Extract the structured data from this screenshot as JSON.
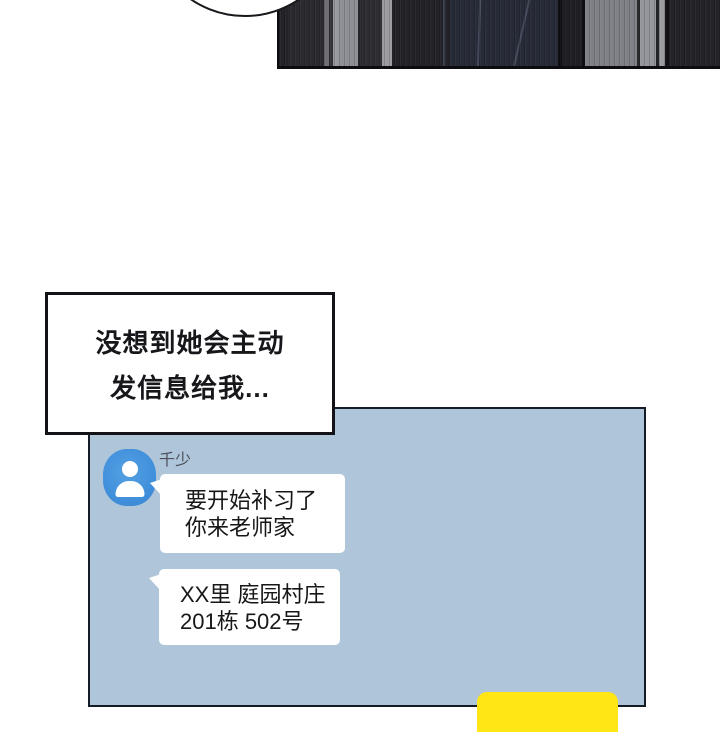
{
  "page": {
    "background": "#ffffff"
  },
  "top_art": {
    "outline_color": "#0d0d11",
    "stripes": [
      {
        "w": 9,
        "c": "#242428"
      },
      {
        "w": 36,
        "c": "#2b2b2f"
      },
      {
        "w": 5,
        "c": "#6e6e74"
      },
      {
        "w": 4,
        "c": "#343438"
      },
      {
        "w": 6,
        "c": "#989aa0"
      },
      {
        "w": 19,
        "c": "#8e9096"
      },
      {
        "w": 4,
        "c": "#2a2a2e"
      },
      {
        "w": 20,
        "c": "#2e2e32"
      },
      {
        "w": 10,
        "c": "#9b9ba1"
      },
      {
        "w": 58,
        "c": "#222228"
      },
      {
        "w": 108,
        "c": "#272b37"
      },
      {
        "w": 4,
        "c": "#0f0f13"
      },
      {
        "w": 20,
        "c": "#1f1f25"
      },
      {
        "w": 3,
        "c": "#101014"
      },
      {
        "w": 52,
        "c": "#7f8187"
      },
      {
        "w": 3,
        "c": "#2c2c30"
      },
      {
        "w": 16,
        "c": "#94969c"
      },
      {
        "w": 3,
        "c": "#222226"
      },
      {
        "w": 6,
        "c": "#9a9ca2"
      },
      {
        "w": 4,
        "c": "#121216"
      },
      {
        "w": 53,
        "c": "#232329"
      }
    ],
    "seams": [
      {
        "left": 164,
        "rotate": 0,
        "color": "#454b5c"
      },
      {
        "left": 199,
        "rotate": 2,
        "color": "#4a5062"
      },
      {
        "left": 241,
        "rotate": 13,
        "color": "#4a5062"
      }
    ]
  },
  "thought_bubble": {
    "lines": [
      "没想到她会主动",
      "发信息给我..."
    ]
  },
  "chat": {
    "sender": {
      "name": "千少",
      "avatar_icon": "person-icon"
    },
    "messages": [
      {
        "type": "received",
        "lines": [
          "要开始补习了",
          "你来老师家"
        ]
      },
      {
        "type": "received",
        "lines": [
          "XX里 庭园村庄",
          "201栋 502号"
        ]
      },
      {
        "type": "sent_partial",
        "lines": []
      }
    ]
  },
  "colors": {
    "chat_bg": "#afc5da",
    "chat_border": "#161c26",
    "avatar_blue": "#4291dc",
    "bubble_white": "#ffffff",
    "sent_yellow": "#ffe614",
    "name_gray": "#4b505a",
    "text_black": "#17171a"
  }
}
